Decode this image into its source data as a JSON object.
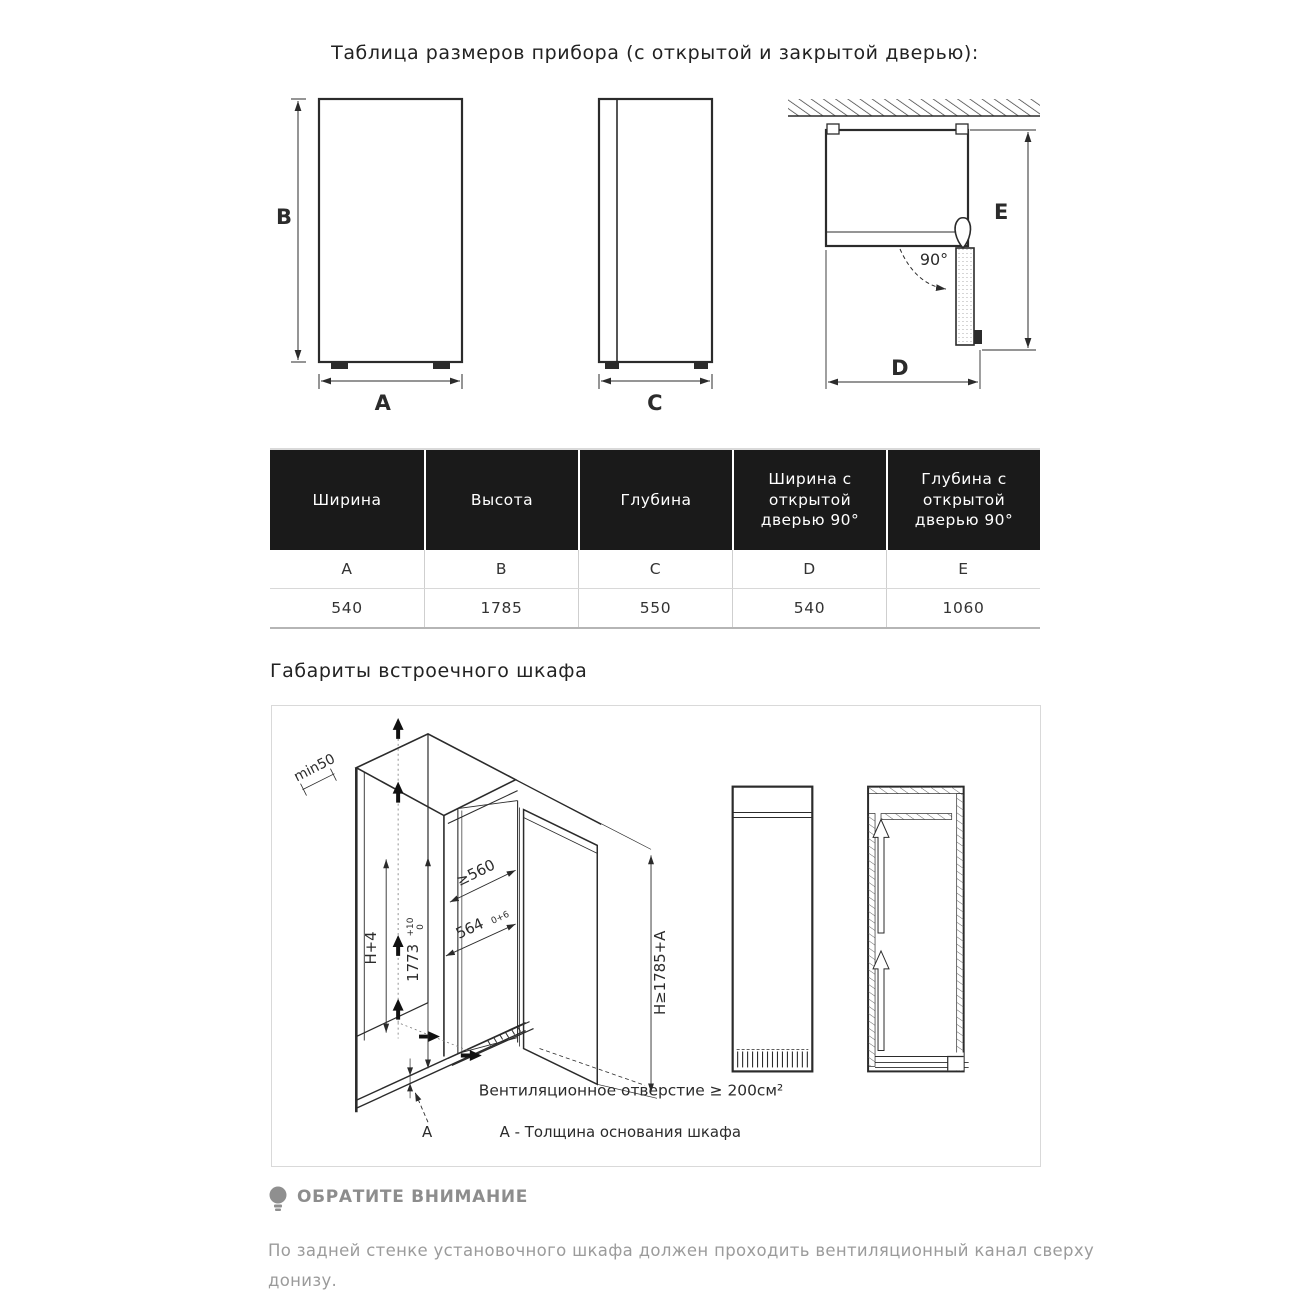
{
  "page": {
    "title": "Таблица размеров прибора (с открытой и закрытой дверью):",
    "section2_title": "Габариты встроечного шкафа"
  },
  "diagrams": {
    "labels": {
      "width_a": "A",
      "height_b": "B",
      "depth_c": "C",
      "door_width_d": "D",
      "door_depth_e": "E",
      "angle": "90°"
    }
  },
  "table": {
    "columns": [
      {
        "header": "Ширина",
        "letter": "A",
        "value": "540"
      },
      {
        "header": "Высота",
        "letter": "B",
        "value": "1785"
      },
      {
        "header": "Глубина",
        "letter": "C",
        "value": "550"
      },
      {
        "header": "Ширина с открытой дверью 90°",
        "letter": "D",
        "value": "540"
      },
      {
        "header": "Глубина с открытой дверью 90°",
        "letter": "E",
        "value": "1060"
      }
    ]
  },
  "cabinet": {
    "min50": "min50",
    "h_plus_4": "H+4",
    "dim_1773": "1773",
    "dim_1773_sup": "+10",
    "dim_1773_sub": "0",
    "dim_560": "≥560",
    "dim_564": "564",
    "dim_564_tol": "0+6",
    "dim_h1785": "H≥1785+A",
    "a_label": "А",
    "vent_label": "Вентиляционное отверстие ≥ 200см²",
    "base_note": "А - Толщина основания шкафа"
  },
  "note": {
    "title": "ОБРАТИТЕ ВНИМАНИЕ",
    "body": "По задней стенке установочного шкафа должен проходить вентиляционный канал сверху донизу."
  },
  "colors": {
    "header_bg": "#1a1a1a",
    "line": "#2b2b2b",
    "note_gray": "#8d8d8d"
  }
}
